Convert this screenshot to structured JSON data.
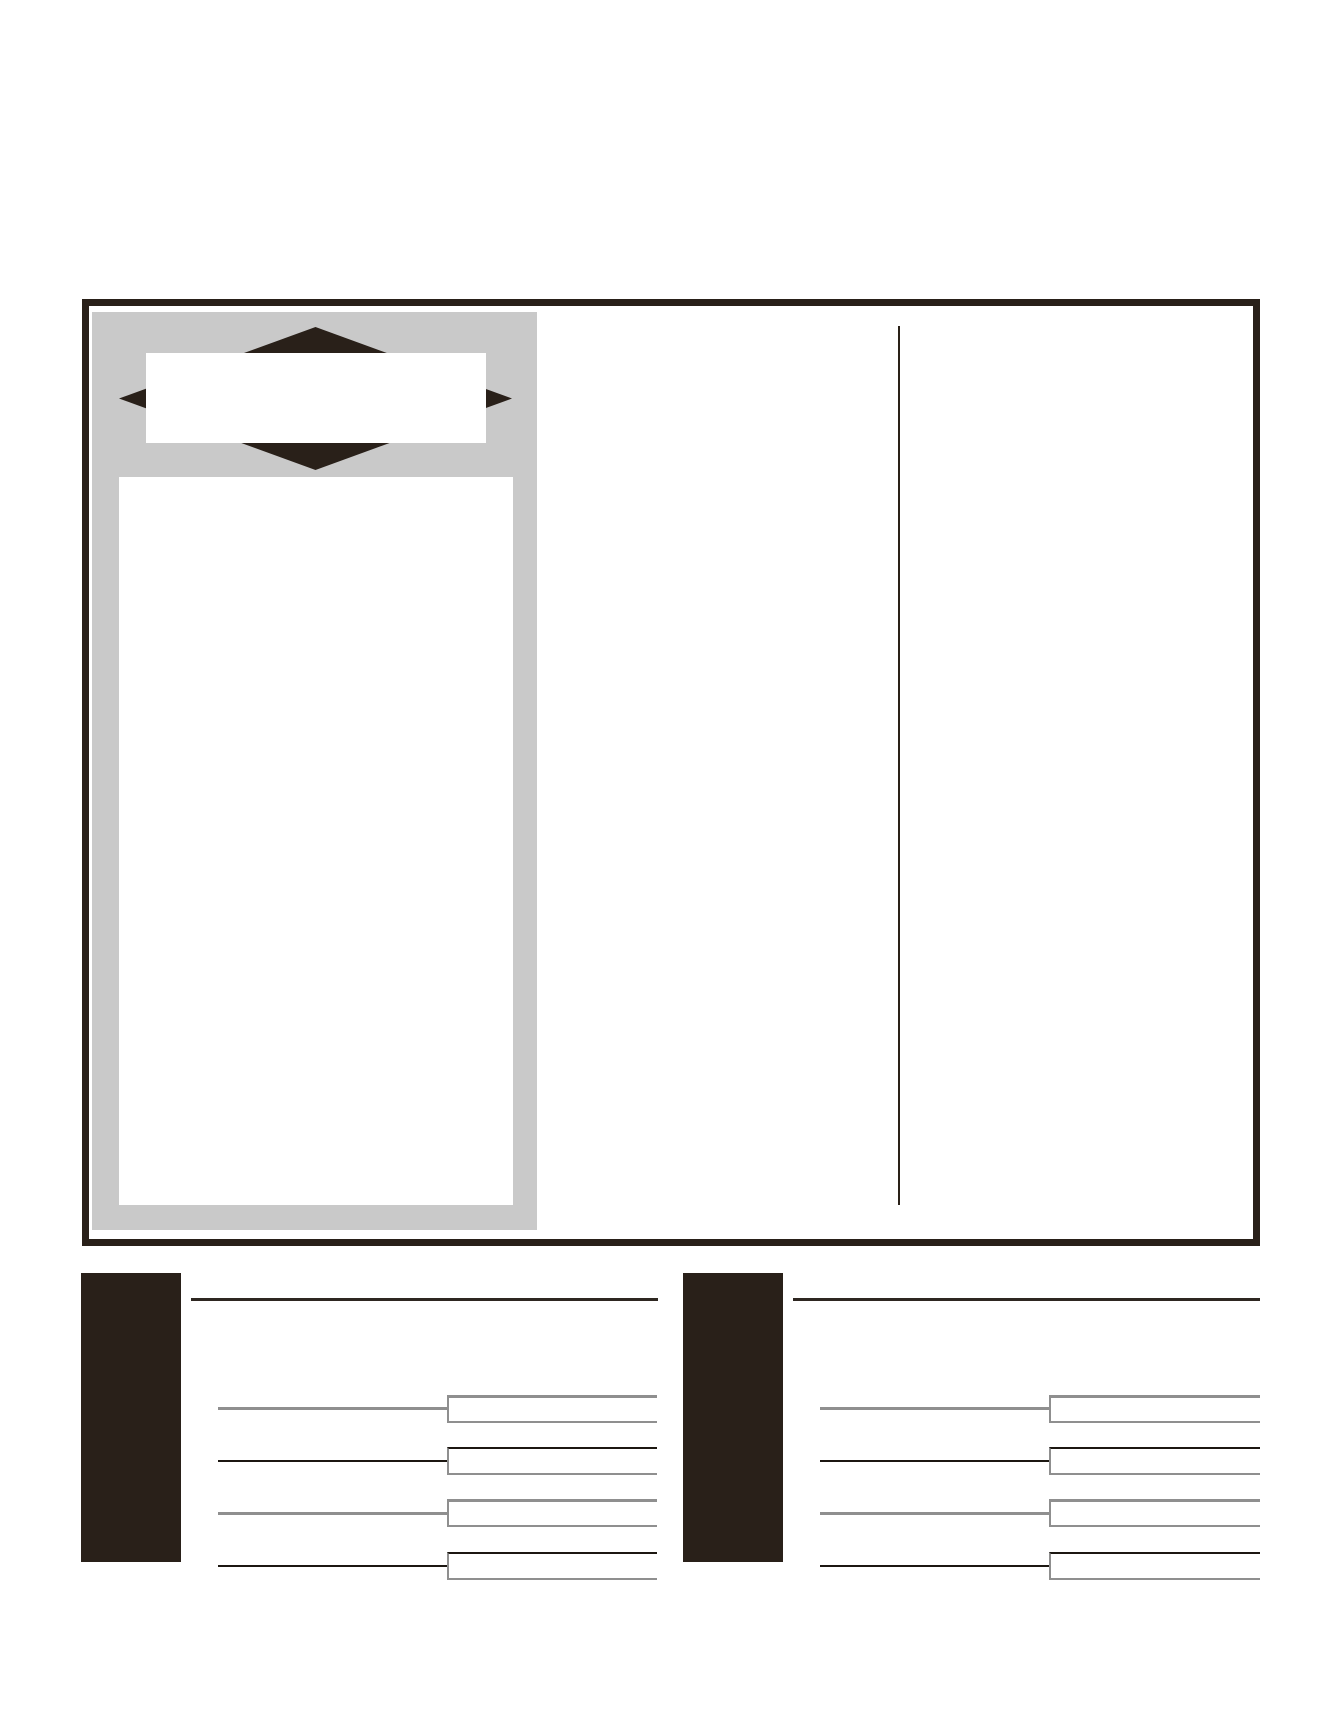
{
  "page": {
    "width": 1338,
    "height": 1731,
    "background": "#ffffff",
    "description_text": ""
  },
  "colors": {
    "frame_border": "#292019",
    "panel_gray": "#c9c9c9",
    "ribbon_dark": "#292019",
    "rule_dark": "#2e2721",
    "field_line_gray": "#8f8f8f",
    "field_line_dark": "#1c1711"
  },
  "main_frame": {
    "title_banner_text": "",
    "photo_area_text": "",
    "right_column_text": ""
  },
  "sections": [
    {
      "label": "",
      "fields": [
        {
          "value": ""
        },
        {
          "value": ""
        },
        {
          "value": ""
        },
        {
          "value": ""
        }
      ]
    },
    {
      "label": "",
      "fields": [
        {
          "value": ""
        },
        {
          "value": ""
        },
        {
          "value": ""
        },
        {
          "value": ""
        }
      ]
    }
  ]
}
